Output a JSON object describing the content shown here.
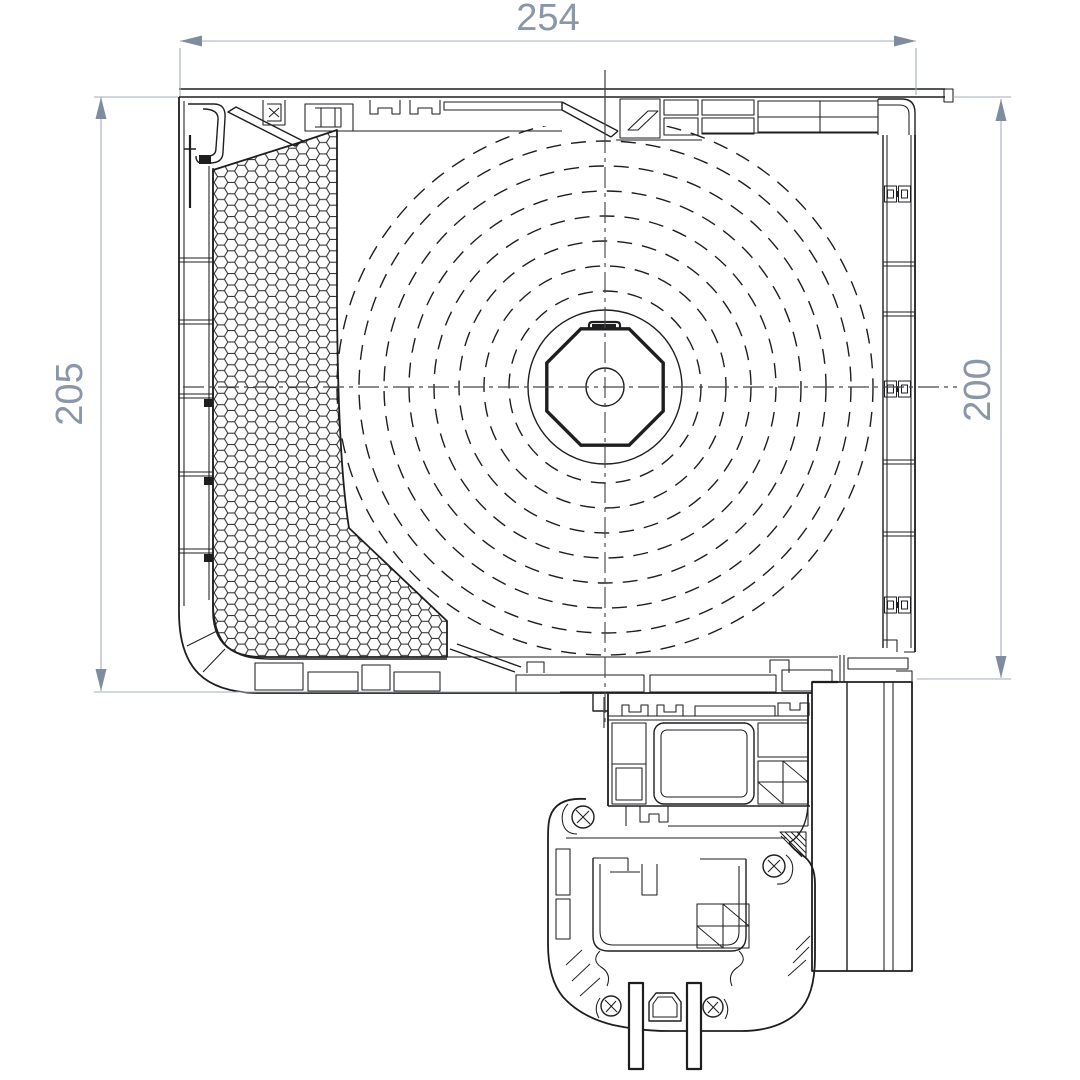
{
  "drawing": {
    "type": "technical-section-drawing",
    "dimensions": {
      "width": "254",
      "height_left": "205",
      "height_right": "200"
    },
    "colors": {
      "line": "#1e1e20",
      "dimension_text": "#8b96a8",
      "dimension_line": "#a6adbb",
      "arrow": "#7f8b9e",
      "background": "#ffffff"
    }
  }
}
